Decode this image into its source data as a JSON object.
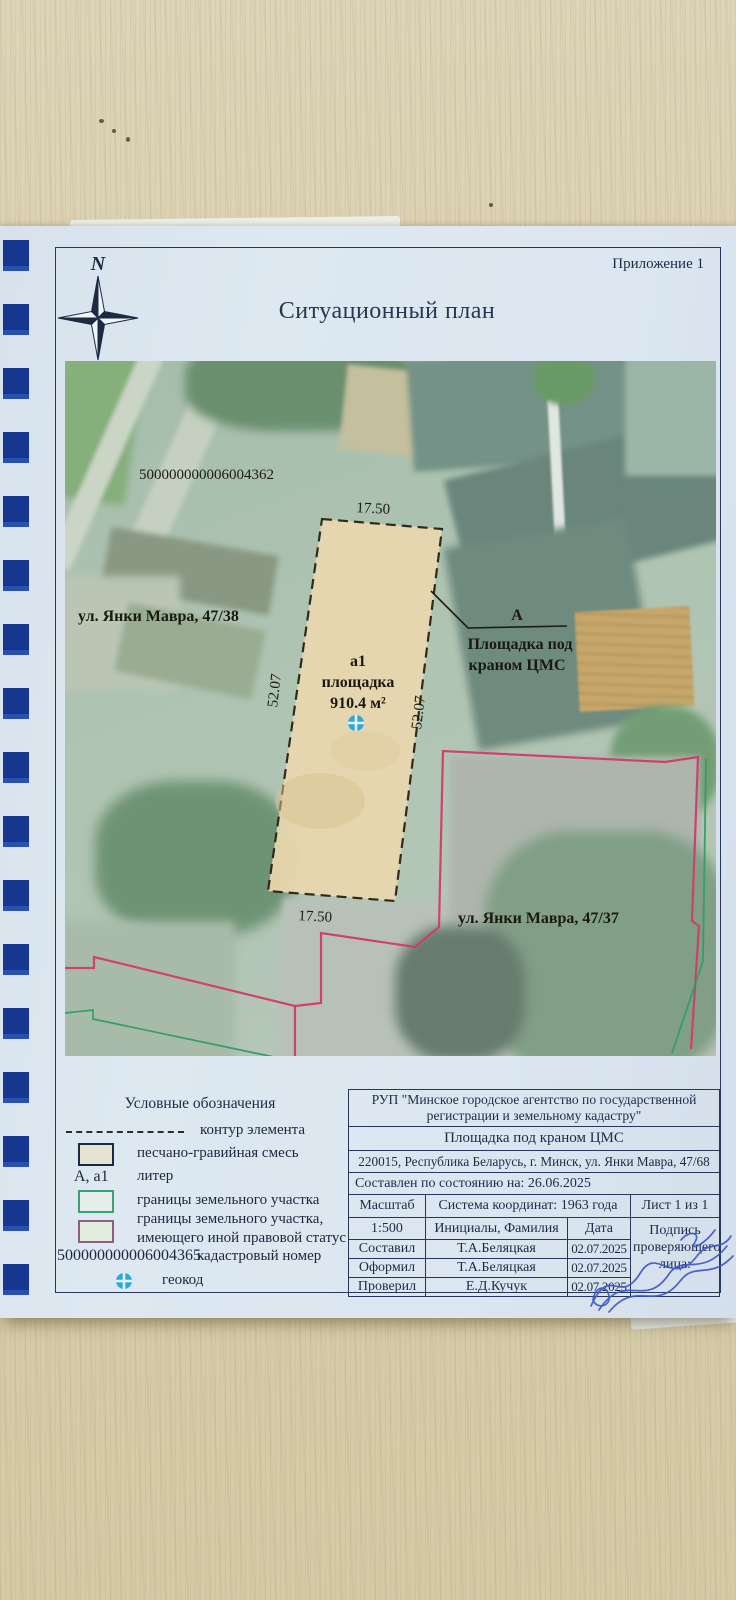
{
  "page": {
    "appendix": "Приложение 1",
    "title": "Ситуационный план"
  },
  "compass": {
    "north": "N",
    "south": "S"
  },
  "map": {
    "cadastral_number": "500000000006004362",
    "street_38": "ул. Янки Мавра, 47/38",
    "street_37": "ул. Янки Мавра, 47/37",
    "parcel": {
      "letter": "а1",
      "kind": "площадка",
      "area": "910.4 м²",
      "top": "17.50",
      "bottom": "17.50",
      "left": "52.07",
      "right": "52.07"
    },
    "callout": {
      "letter": "А",
      "line1": "Площадка под",
      "line2": "краном ЦМС"
    }
  },
  "legend": {
    "title": "Условные обозначения",
    "contour": "контур элемента",
    "gravel": "песчано-гравийная смесь",
    "liter_key": "А, а1",
    "liter": "литер",
    "bounds": "границы земельного участка",
    "bounds_other_1": "границы земельного участка,",
    "bounds_other_2": "имеющего иной правовой статус",
    "cad_number": "500000000006004365",
    "cad_label": "кадастровый номер",
    "geocode": "геокод"
  },
  "table": {
    "org": "РУП \"Минское городское агентство по государственной регистрации и земельному кадастру\"",
    "object": "Площадка под краном ЦМС",
    "address": "220015, Республика Беларусь, г. Минск, ул. Янки Мавра, 47/68",
    "compiled": "Составлен по состоянию на: 26.06.2025",
    "scale_label": "Масштаб",
    "coord_system": "Система координат: 1963 года",
    "sheet": "Лист 1 из 1",
    "scale_value": "1:500",
    "initials_header": "Инициалы, Фамилия",
    "date_header": "Дата",
    "sign_label": "Подпись проверяющего лица:",
    "rows": [
      {
        "role": "Составил",
        "name": "Т.А.Беляцкая",
        "date": "02.07.2025"
      },
      {
        "role": "Оформил",
        "name": "Т.А.Беляцкая",
        "date": "02.07.2025"
      },
      {
        "role": "Проверил",
        "name": "Е.Д.Кучук",
        "date": "02.07.2025"
      }
    ]
  },
  "colors": {
    "accent_pink": "#d23a6b",
    "accent_green": "#2f9e63",
    "geocode_blue": "#2aa9e1",
    "parcel_tan": "#e9d7ae",
    "binding_blue": "#1c3fa0",
    "ink_navy": "#26365c",
    "signature_blue": "#3a55c8"
  }
}
